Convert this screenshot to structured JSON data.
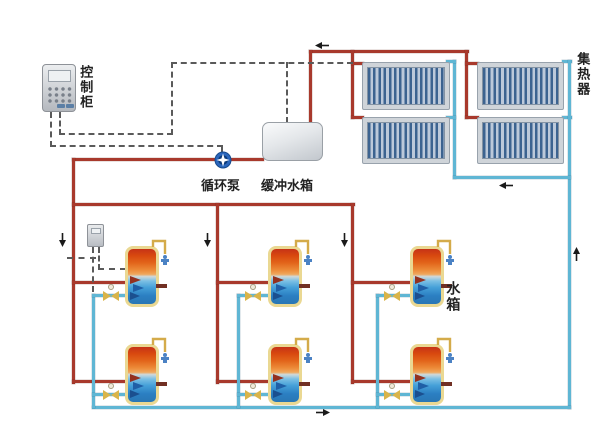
{
  "diagram": {
    "type": "solar-water-heating-system-schematic",
    "labels": {
      "control_cabinet": "控制柜",
      "circulation_pump": "循环泵",
      "buffer_tank": "缓冲水箱",
      "solar_collector": "集热器",
      "water_tank": "水箱"
    },
    "legend_colors": {
      "hot_water_pipe": "#a8392c",
      "cold_water_pipe": "#5fb6d4",
      "control_wire": "#5a5a5a",
      "valve": "#d9b44a",
      "pump": "#2a66bc"
    },
    "component_counts": {
      "solar_collector_panels": 4,
      "storage_tanks": 6,
      "circulation_pumps": 1,
      "valves": 6,
      "controllers": 2
    }
  }
}
